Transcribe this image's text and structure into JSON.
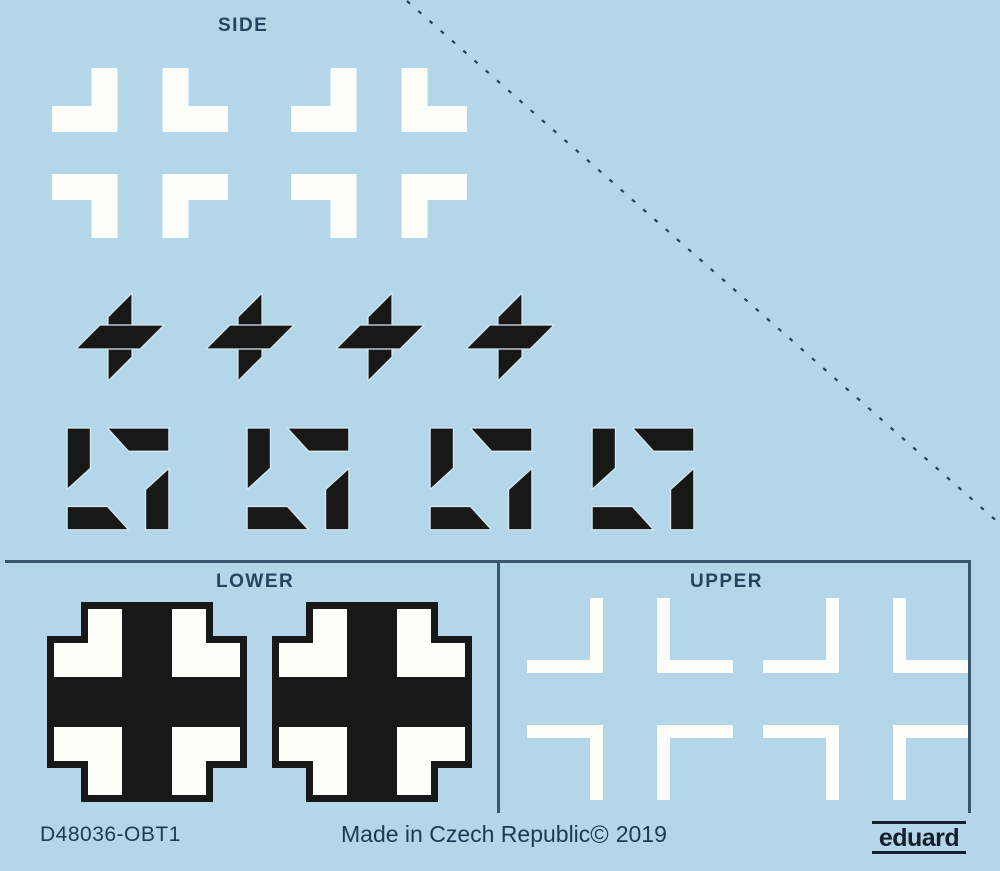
{
  "sheet": {
    "background": "#b3d7e9",
    "description": "Eduard waterslide decal sheet with German national insignia"
  },
  "sections": {
    "side": {
      "label": "SIDE",
      "decal_type": "white outline crosses",
      "count": 2
    },
    "lower": {
      "label": "LOWER",
      "decal_type": "black crosses with white outline",
      "count": 2
    },
    "upper": {
      "label": "UPPER",
      "decal_type": "white outline crosses",
      "count": 2
    }
  },
  "markings": {
    "tail_marking_center_parts": 4,
    "tail_marking_corner_parts": 4
  },
  "footer": {
    "product_code": "D48036-OBT1",
    "made_in": "Made in Czech Republic",
    "copyright_symbol": "©",
    "year": "2019",
    "brand": "eduard"
  },
  "colors": {
    "decal_black": "#181818",
    "decal_white": "#fdfdfa",
    "label_text": "#24455f",
    "footer_text": "#1a3a55",
    "line": "#3a556e",
    "brand_text": "#161f2b"
  }
}
